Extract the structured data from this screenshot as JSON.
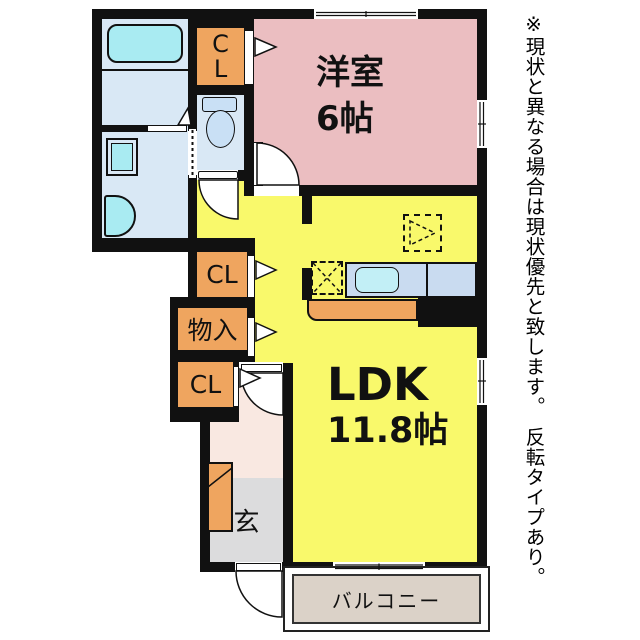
{
  "rooms": {
    "western": {
      "label": "洋室",
      "size": "6帖"
    },
    "ldk": {
      "label": "LDK",
      "size": "11.8帖"
    },
    "closet_in_western": {
      "letters": [
        "C",
        "L"
      ]
    },
    "closet_middle": {
      "label": "CL"
    },
    "storage": {
      "label": "物入"
    },
    "closet_lower": {
      "label": "CL"
    },
    "entrance": {
      "label": "玄"
    },
    "balcony": {
      "label": "バルコニー"
    }
  },
  "note": {
    "text": "※現状と異なる場合は現状優先と致します。　反転タイプあり。"
  },
  "colors": {
    "wall": "#111111",
    "western_room": "#EBBEC1",
    "ldk": "#F9F96B",
    "closet": "#EFA55F",
    "sanitary_room": "#D9E8F5",
    "fixture_cyan": "#A9EBF2",
    "toilet_fill": "#C9E0F5",
    "kitchen_counter": "#C9DBF0",
    "kitchen_sink": "#C2EFF6",
    "hallway": "#F9E8E1",
    "entrance_floor": "#DCDCDD",
    "balcony_floor": "#DBD2C8"
  },
  "fixtures": [
    "bathtub",
    "washing-machine",
    "vanity-sink",
    "toilet",
    "kitchen-counter",
    "kitchen-sink",
    "stove-position",
    "refrigerator-position",
    "shoe-cabinet"
  ]
}
